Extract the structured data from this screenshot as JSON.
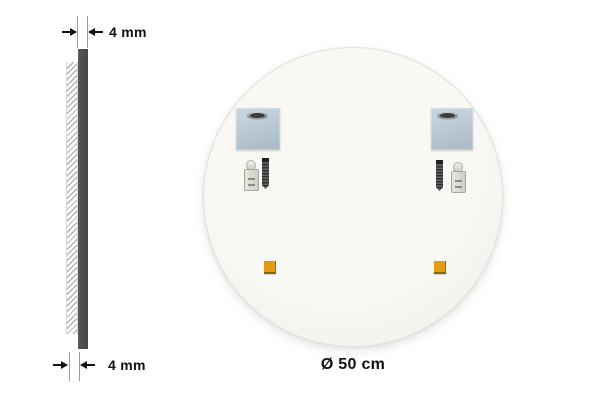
{
  "colors": {
    "ink": "#111111",
    "glass": "#4f4f4f",
    "bracket-light": "#ccd7e0",
    "bracket-dark": "#aab9c6",
    "pad": "#e29b12",
    "mirror-center": "#f9f8f4",
    "mirror-edge": "#efede6"
  },
  "side_view": {
    "top_dimension": {
      "label": "4 mm"
    },
    "bottom_dimension": {
      "label": "4 mm"
    }
  },
  "mirror": {
    "diameter_label": "Ø 50 cm",
    "hardware": {
      "mounting_brackets": 2,
      "keyhole_slots": 2,
      "wall_plugs": 2,
      "screws": 2,
      "adhesive_pads": 2
    }
  }
}
